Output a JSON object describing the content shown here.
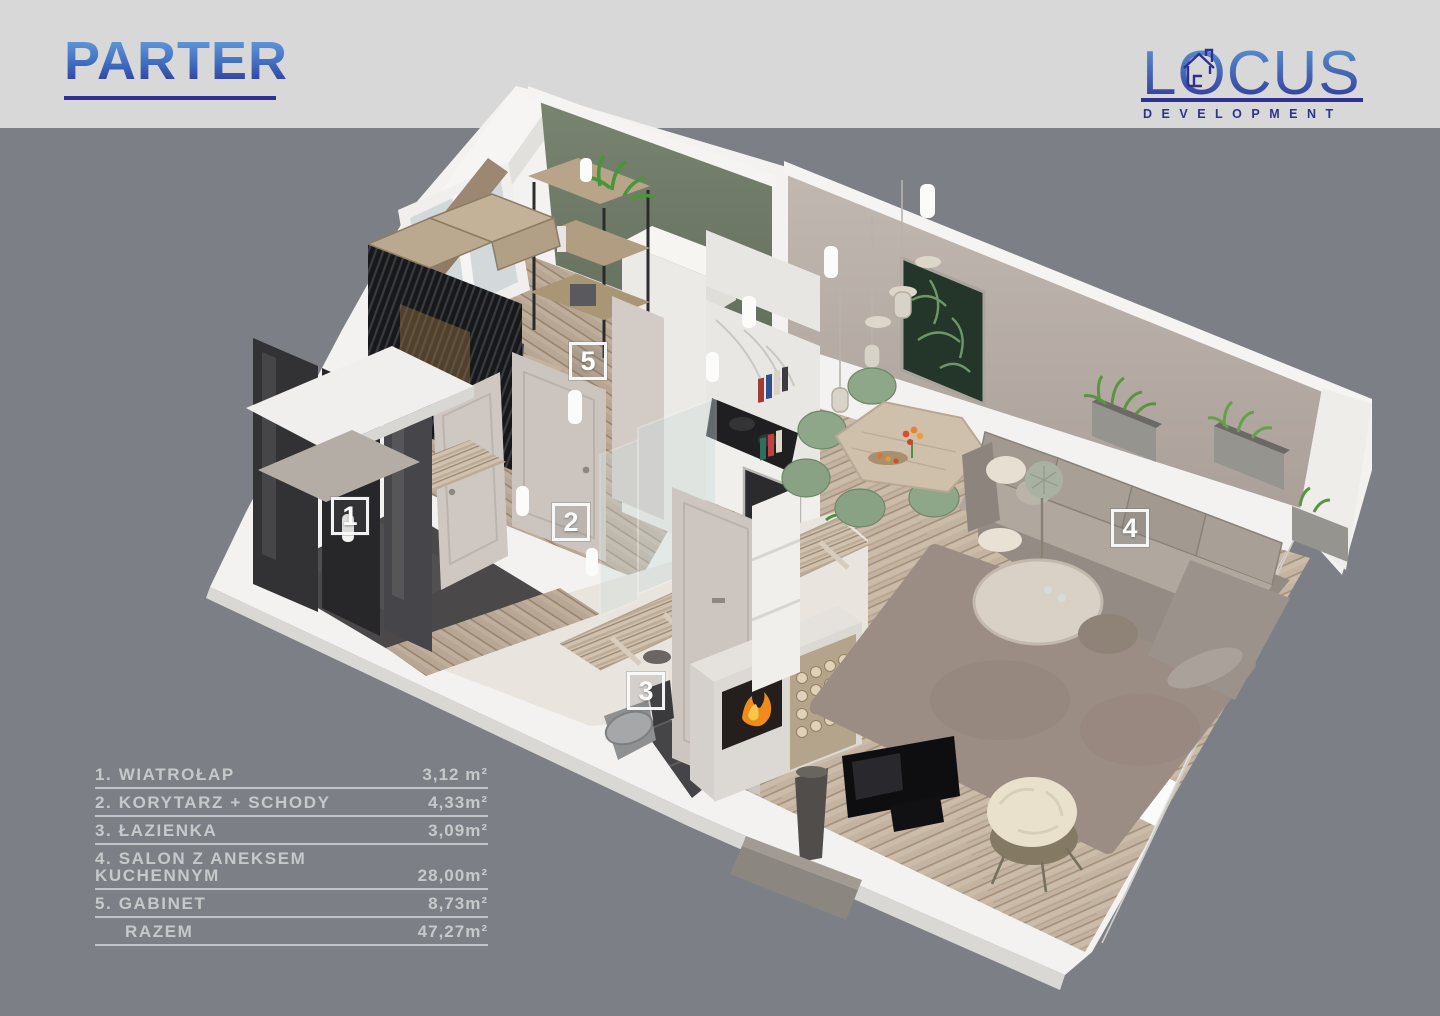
{
  "header": {
    "title": "PARTER"
  },
  "logo": {
    "name": "LOCUS",
    "subtitle": "DEVELOPMENT"
  },
  "legend": {
    "rows": [
      {
        "label": "1. WIATROŁAP",
        "area": "3,12 m²"
      },
      {
        "label": "2. KORYTARZ + SCHODY",
        "area": "4,33m²"
      },
      {
        "label": "3. ŁAZIENKA",
        "area": "3,09m²"
      },
      {
        "label": "4. SALON Z ANEKSEM KUCHENNYM",
        "area": "28,00m²"
      },
      {
        "label": "5. GABINET",
        "area": "8,73m²"
      },
      {
        "label": "RAZEM",
        "area": "47,27m²"
      }
    ]
  },
  "markers": [
    {
      "number": "1"
    },
    {
      "number": "2"
    },
    {
      "number": "3"
    },
    {
      "number": "4"
    },
    {
      "number": "5"
    }
  ],
  "colors": {
    "background": "#7c8086",
    "top_band": "#d8d8d8",
    "brand_blue_light": "#69a4dd",
    "brand_blue_dark": "#2e3192",
    "legend_text": "#c7c8ca",
    "marker_white": "#fdfdfd",
    "slab_white": "#f3f2f0",
    "wall_taupe": "#b9afa9",
    "accent_wall_green": "#717c6b",
    "wood_floor": "#c4b3a1"
  }
}
